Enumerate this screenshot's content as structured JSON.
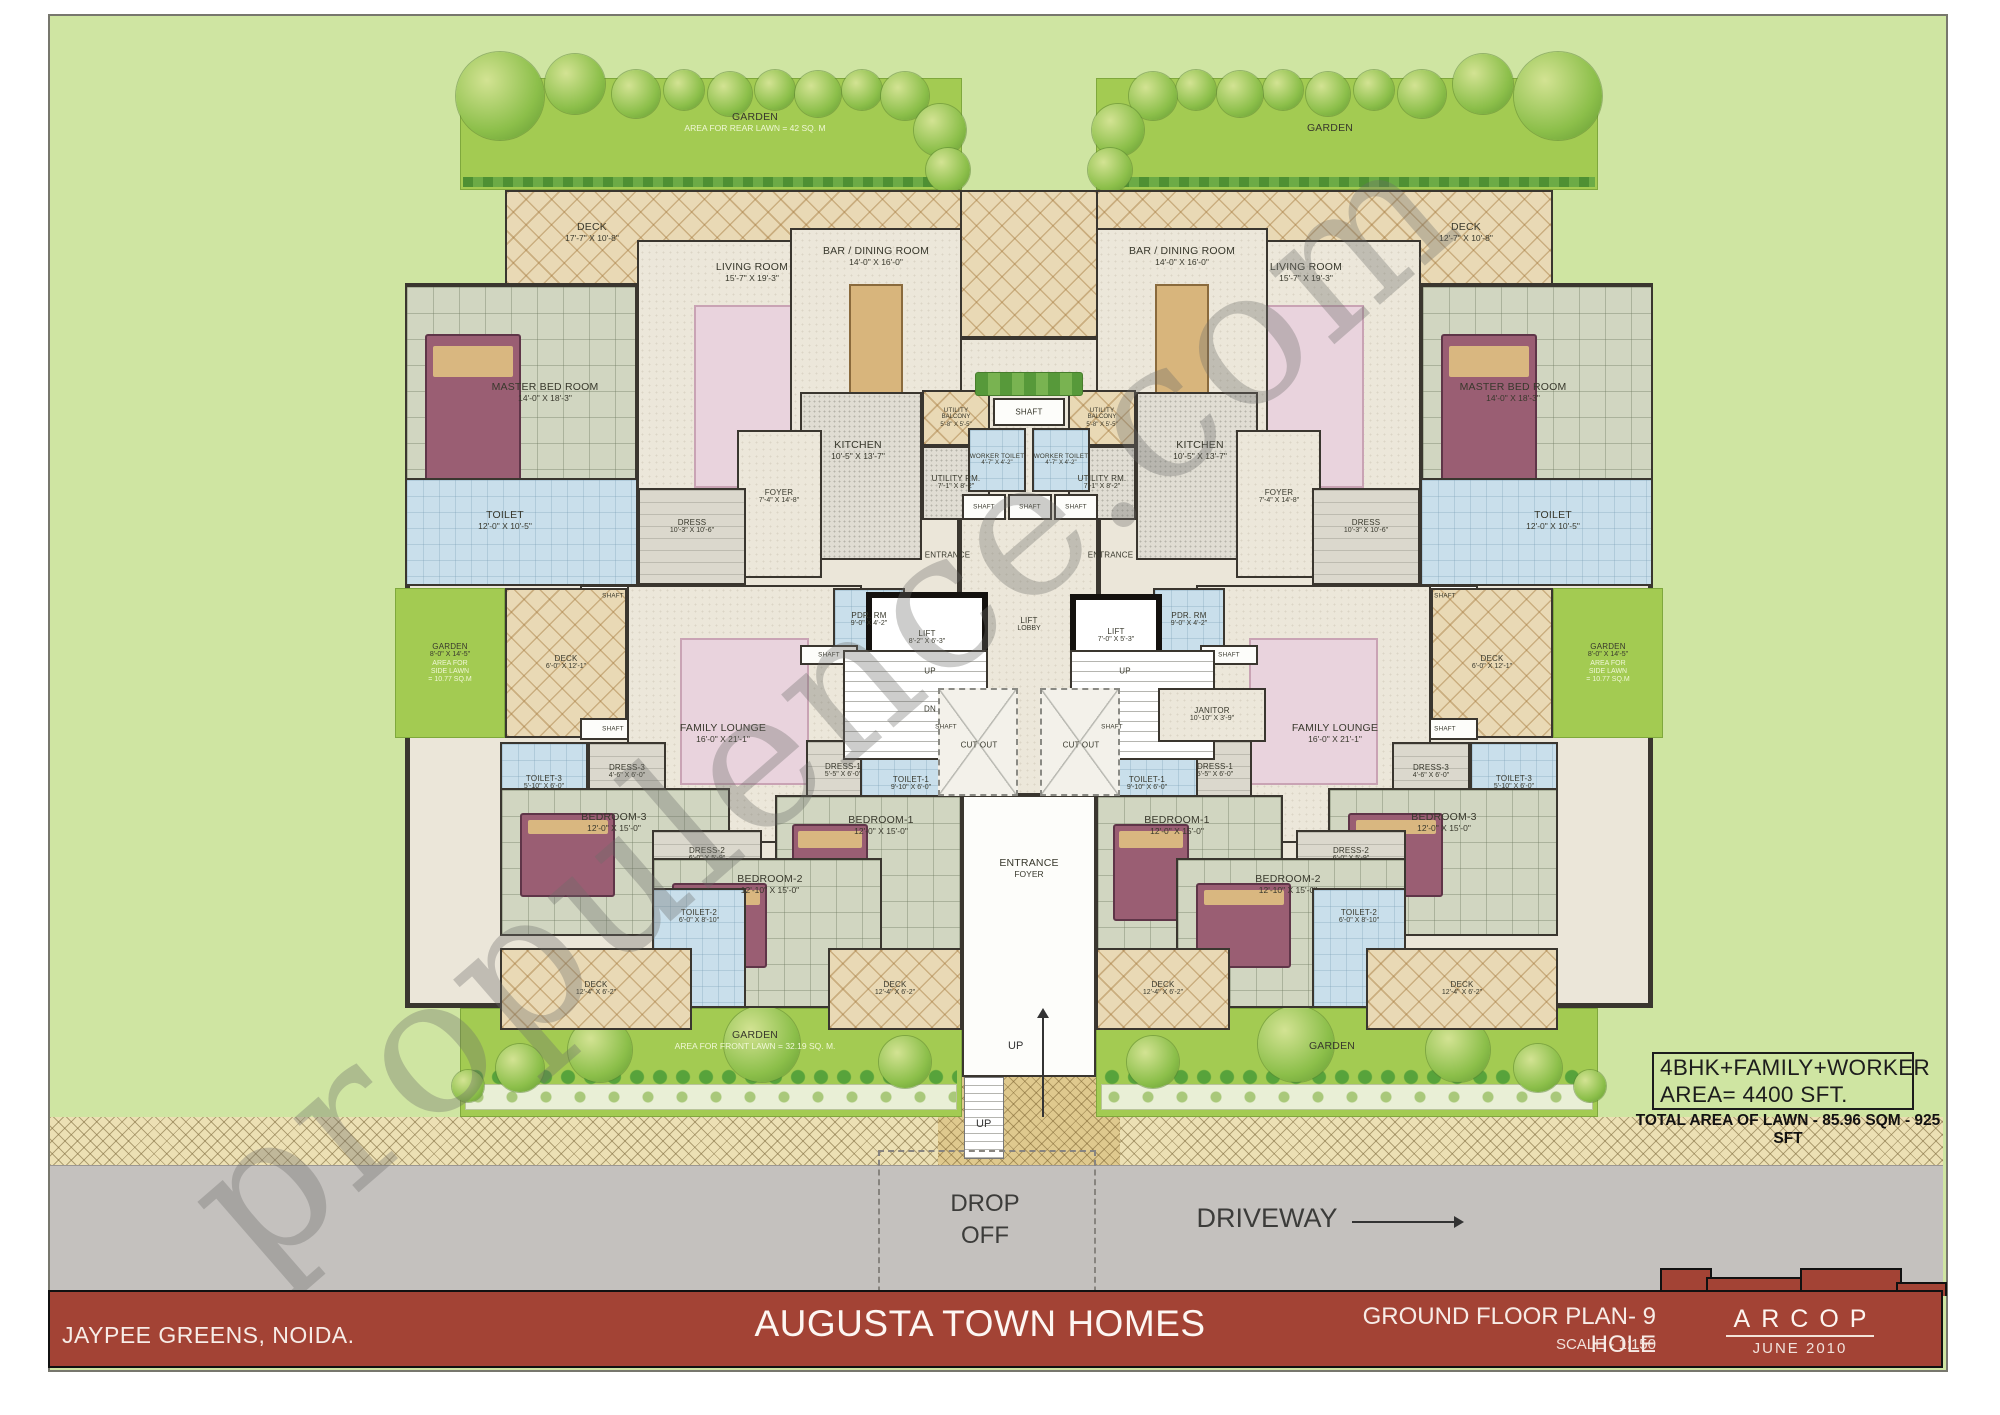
{
  "watermark": "propulence.com",
  "title_bar": {
    "left": "JAYPEE GREENS, NOIDA.",
    "title": "AUGUSTA TOWN HOMES",
    "plan": "GROUND FLOOR PLAN- 9 HOLE",
    "scale": "SCALE - 1:150",
    "firm": "ARCOP",
    "date": "JUNE  2010"
  },
  "annotations": {
    "line1": "4BHK+FAMILY+WORKER",
    "line2": "AREA= 4400 SFT.",
    "line3": "TOTAL AREA OF LAWN - 85.96 SQM - 925 SFT"
  },
  "site": {
    "drop_off_1": "DROP",
    "drop_off_2": "OFF",
    "driveway": "DRIVEWAY",
    "up": "UP"
  },
  "plan": {
    "background": [
      {
        "id": "center-deck",
        "cls": "hatch",
        "x": 880,
        "y": 190,
        "w": 298,
        "h": 148
      },
      {
        "id": "core-floor",
        "cls": "beige",
        "x": 903,
        "y": 338,
        "w": 252,
        "h": 457
      },
      {
        "id": "drop-path",
        "cls": "herring",
        "x": 938,
        "y": 1077,
        "w": 182,
        "h": 88
      },
      {
        "id": "drop-ramp",
        "cls": "ramp",
        "x": 964,
        "y": 1077,
        "w": 40,
        "h": 82
      }
    ],
    "gardens": [
      {
        "id": "garden-rear-left",
        "cls": "lawn",
        "x": 460,
        "y": 78,
        "w": 502,
        "h": 112,
        "lx": 755,
        "ly": 122,
        "lines": [
          "GARDEN",
          "AREA FOR REAR LAWN = 42 SQ. M"
        ],
        "light": 1,
        "strip": "hedge"
      },
      {
        "id": "garden-rear-right",
        "cls": "lawn",
        "x": 1096,
        "y": 78,
        "w": 502,
        "h": 112,
        "lx": 1330,
        "ly": 128,
        "lines": [
          "GARDEN"
        ],
        "strip": "hedge"
      },
      {
        "id": "garden-front-left",
        "cls": "lawn",
        "x": 460,
        "y": 1008,
        "w": 502,
        "h": 109,
        "lx": 755,
        "ly": 1040,
        "lines": [
          "GARDEN",
          "AREA FOR FRONT LAWN = 32.19 SQ. M."
        ],
        "light": 1,
        "strip": "shrub"
      },
      {
        "id": "garden-front-right",
        "cls": "lawn",
        "x": 1096,
        "y": 1008,
        "w": 502,
        "h": 109,
        "lx": 1332,
        "ly": 1046,
        "lines": [
          "GARDEN"
        ],
        "strip": "shrub"
      }
    ],
    "unit_rooms": [
      {
        "id": "deck-top",
        "cls": "hatch",
        "x": 505,
        "y": 190,
        "w": 457,
        "h": 95,
        "lx": 592,
        "ly": 232,
        "lines": [
          "DECK",
          "17'-7\" X 10'-8\""
        ],
        "rlines": [
          "DECK",
          "12'-7\" X 10'-8\""
        ]
      },
      {
        "id": "shell",
        "cls": "shell",
        "x": 405,
        "y": 283,
        "w": 557,
        "h": 725
      },
      {
        "id": "master-bed-room",
        "cls": "tile",
        "x": 405,
        "y": 285,
        "w": 232,
        "h": 300,
        "lx": 545,
        "ly": 392,
        "lines": [
          "MASTER BED ROOM",
          "14'-0\" X 18'-3\""
        ],
        "decor": "bed"
      },
      {
        "id": "living-room",
        "cls": "beige",
        "x": 637,
        "y": 240,
        "w": 252,
        "h": 320,
        "lx": 752,
        "ly": 272,
        "lines": [
          "LIVING ROOM",
          "15'-7\" X 19'-3\""
        ],
        "decor": "rug"
      },
      {
        "id": "bar-dining-room",
        "cls": "beige",
        "x": 790,
        "y": 228,
        "w": 172,
        "h": 230,
        "lx": 876,
        "ly": 256,
        "lines": [
          "BAR / DINING ROOM",
          "14'-0\" X 16'-0\""
        ],
        "decor": "table"
      },
      {
        "id": "kitchen",
        "cls": "kitchenf",
        "x": 800,
        "y": 392,
        "w": 122,
        "h": 168,
        "lx": 858,
        "ly": 450,
        "lines": [
          "KITCHEN",
          "10'-5\" X 13'-7\""
        ]
      },
      {
        "id": "foyer",
        "cls": "beige",
        "x": 737,
        "y": 430,
        "w": 85,
        "h": 148,
        "lx": 779,
        "ly": 497,
        "lines": [
          "FOYER",
          "7'-4\" X 14'-8\""
        ],
        "small": true
      },
      {
        "id": "toilet-master",
        "cls": "blue",
        "x": 405,
        "y": 478,
        "w": 233,
        "h": 108,
        "lx": 505,
        "ly": 520,
        "lines": [
          "TOILET",
          "12'-0\" X 10'-5\""
        ]
      },
      {
        "id": "dress-master",
        "cls": "grey",
        "x": 638,
        "y": 488,
        "w": 108,
        "h": 97,
        "lx": 692,
        "ly": 527,
        "lines": [
          "DRESS",
          "10'-3\" X 10'-6\""
        ],
        "small": true
      },
      {
        "id": "utility-balcony",
        "cls": "hatch",
        "x": 922,
        "y": 390,
        "w": 68,
        "h": 56,
        "lines": [
          "UTILITY",
          "BALCONY",
          "5'-8\" X 5'-5\""
        ],
        "small": true,
        "tiny": true
      },
      {
        "id": "utility-rm",
        "cls": "kitchenf",
        "x": 922,
        "y": 446,
        "w": 68,
        "h": 74,
        "lines": [
          "UTILITY RM.",
          "7'-1\" X 8'-2\""
        ],
        "small": true
      },
      {
        "id": "shaft-a",
        "cls": "white",
        "x": 580,
        "y": 585,
        "w": 66,
        "h": 22,
        "lines": [
          "SHAFT"
        ],
        "small": true,
        "tiny": true
      },
      {
        "id": "garden-side",
        "cls": "lawn",
        "x": 395,
        "y": 588,
        "w": 110,
        "h": 150,
        "lines": [
          "GARDEN",
          "8'-0\" X 14'-5\"",
          "AREA FOR",
          "SIDE LAWN",
          "= 10.77 SQ.M"
        ],
        "light": 2,
        "small": true
      },
      {
        "id": "deck-side",
        "cls": "hatch",
        "x": 505,
        "y": 588,
        "w": 122,
        "h": 150,
        "lines": [
          "DECK",
          "6'-0\" X 12'-1\""
        ],
        "small": true
      },
      {
        "id": "shaft-b",
        "cls": "white",
        "x": 580,
        "y": 718,
        "w": 66,
        "h": 22,
        "lines": [
          "SHAFT"
        ],
        "small": true,
        "tiny": true
      },
      {
        "id": "family-lounge",
        "cls": "beige",
        "x": 627,
        "y": 585,
        "w": 235,
        "h": 258,
        "lx": 723,
        "ly": 733,
        "lines": [
          "FAMILY LOUNGE",
          "16'-0\" X 21'-1\""
        ],
        "decor": "rug"
      },
      {
        "id": "pdr-rm",
        "cls": "blue",
        "x": 833,
        "y": 588,
        "w": 72,
        "h": 64,
        "lines": [
          "PDR. RM",
          "9'-0\" X 4'-2\""
        ],
        "small": true
      },
      {
        "id": "shaft-c",
        "cls": "white",
        "x": 800,
        "y": 645,
        "w": 58,
        "h": 20,
        "lines": [
          "SHAFT"
        ],
        "small": true,
        "tiny": true
      },
      {
        "id": "dress-3",
        "cls": "grey",
        "x": 588,
        "y": 742,
        "w": 78,
        "h": 60,
        "lines": [
          "DRESS-3",
          "4'-6\" X 6'-0\""
        ],
        "small": true
      },
      {
        "id": "toilet-3",
        "cls": "blue",
        "x": 500,
        "y": 742,
        "w": 88,
        "h": 82,
        "lines": [
          "TOILET-3",
          "5'-10\" X 6'-0\""
        ],
        "small": true
      },
      {
        "id": "dress-1",
        "cls": "grey",
        "x": 806,
        "y": 740,
        "w": 74,
        "h": 62,
        "lines": [
          "DRESS-1",
          "5'-5\" X 6'-0\""
        ],
        "small": true
      },
      {
        "id": "toilet-1",
        "cls": "blue",
        "x": 860,
        "y": 735,
        "w": 102,
        "h": 97,
        "lines": [
          "TOILET-1",
          "9'-10\" X 6'-0\""
        ],
        "small": true
      },
      {
        "id": "shaft-d",
        "cls": "white",
        "x": 925,
        "y": 718,
        "w": 42,
        "h": 18,
        "lines": [
          "SHAFT"
        ],
        "small": true,
        "tiny": true
      },
      {
        "id": "bedroom-3",
        "cls": "tile",
        "x": 500,
        "y": 788,
        "w": 230,
        "h": 148,
        "lx": 614,
        "ly": 822,
        "lines": [
          "BEDROOM-3",
          "12'-0\" X 15'-0\""
        ],
        "decor": "bed"
      },
      {
        "id": "bedroom-1",
        "cls": "tile",
        "x": 775,
        "y": 795,
        "w": 187,
        "h": 172,
        "lx": 881,
        "ly": 825,
        "lines": [
          "BEDROOM-1",
          "12'-0\" X 15'-0\""
        ],
        "decor": "bed"
      },
      {
        "id": "dress-2",
        "cls": "grey",
        "x": 652,
        "y": 830,
        "w": 110,
        "h": 62,
        "lx": 707,
        "ly": 855,
        "lines": [
          "DRESS-2",
          "6'-0\" X 5'-9\""
        ],
        "small": true
      },
      {
        "id": "bedroom-2",
        "cls": "tile",
        "x": 652,
        "y": 858,
        "w": 230,
        "h": 150,
        "lx": 770,
        "ly": 884,
        "lines": [
          "BEDROOM-2",
          "12'-10\" X 15'-0\""
        ],
        "decor": "bed"
      },
      {
        "id": "toilet-2",
        "cls": "blue",
        "x": 652,
        "y": 888,
        "w": 94,
        "h": 120,
        "lx": 699,
        "ly": 917,
        "lines": [
          "TOILET-2",
          "6'-0\" X 8'-10\""
        ],
        "small": true
      },
      {
        "id": "deck-bottom-outer",
        "cls": "hatch",
        "x": 500,
        "y": 948,
        "w": 192,
        "h": 82,
        "lines": [
          "DECK",
          "12'-4\" X 6'-2\""
        ],
        "small": true
      },
      {
        "id": "deck-bottom-inner",
        "cls": "hatch",
        "x": 828,
        "y": 948,
        "w": 134,
        "h": 82,
        "lines": [
          "DECK",
          "12'-4\" X 6'-2\""
        ],
        "small": true
      }
    ],
    "core_rooms": [
      {
        "id": "entrance-foyer",
        "cls": "white",
        "x": 962,
        "y": 795,
        "w": 134,
        "h": 282,
        "lx": 1029,
        "ly": 868,
        "lines": [
          "ENTRANCE",
          "FOYER"
        ]
      },
      {
        "id": "hedge-row",
        "cls": "hedge",
        "x": 975,
        "y": 372,
        "w": 108,
        "h": 24
      },
      {
        "id": "shaft-top",
        "cls": "white",
        "x": 993,
        "y": 398,
        "w": 72,
        "h": 28,
        "lines": [
          "SHAFT"
        ],
        "small": true
      },
      {
        "id": "worker-toilet-left",
        "cls": "blue",
        "x": 968,
        "y": 428,
        "w": 58,
        "h": 64,
        "lines": [
          "WORKER TOILET",
          "4'-7\" X 4'-2\""
        ],
        "small": true,
        "tiny": true
      },
      {
        "id": "worker-toilet-right",
        "cls": "blue",
        "x": 1032,
        "y": 428,
        "w": 58,
        "h": 64,
        "lines": [
          "WORKER TOILET",
          "4'-7\" X 4'-2\""
        ],
        "small": true,
        "tiny": true
      },
      {
        "id": "shaft-1",
        "cls": "white",
        "x": 962,
        "y": 494,
        "w": 44,
        "h": 26,
        "lines": [
          "SHAFT"
        ],
        "small": true,
        "tiny": true
      },
      {
        "id": "shaft-2",
        "cls": "white",
        "x": 1008,
        "y": 494,
        "w": 44,
        "h": 26,
        "lines": [
          "SHAFT"
        ],
        "small": true,
        "tiny": true
      },
      {
        "id": "shaft-3",
        "cls": "white",
        "x": 1054,
        "y": 494,
        "w": 44,
        "h": 26,
        "lines": [
          "SHAFT"
        ],
        "small": true,
        "tiny": true
      },
      {
        "id": "entrance-left",
        "cls": "labelonly",
        "x": 900,
        "y": 542,
        "w": 95,
        "h": 26,
        "lines": [
          "ENTRANCE"
        ],
        "small": true
      },
      {
        "id": "entrance-right",
        "cls": "labelonly",
        "x": 1063,
        "y": 542,
        "w": 95,
        "h": 26,
        "lines": [
          "ENTRANCE"
        ],
        "small": true
      },
      {
        "id": "lift-left",
        "cls": "lift",
        "x": 866,
        "y": 592,
        "w": 122,
        "h": 92,
        "lines": [
          "LIFT",
          "8'-2\" X 6'-3\""
        ],
        "small": true
      },
      {
        "id": "lift-right",
        "cls": "lift",
        "x": 1070,
        "y": 594,
        "w": 92,
        "h": 84,
        "lines": [
          "LIFT",
          "7'-0\" X 5'-3\""
        ],
        "small": true
      },
      {
        "id": "lift-lobby",
        "cls": "labelonly",
        "x": 984,
        "y": 605,
        "w": 90,
        "h": 40,
        "lines": [
          "LIFT",
          "LOBBY"
        ],
        "small": true
      },
      {
        "id": "stairs-left",
        "cls": "stairs",
        "x": 843,
        "y": 650,
        "w": 145,
        "h": 110
      },
      {
        "id": "stairs-right",
        "cls": "stairs",
        "x": 1070,
        "y": 650,
        "w": 145,
        "h": 110
      },
      {
        "id": "up-left",
        "cls": "labelonly",
        "x": 905,
        "y": 662,
        "w": 50,
        "h": 18,
        "lines": [
          "UP"
        ],
        "small": true
      },
      {
        "id": "dn-left",
        "cls": "labelonly",
        "x": 905,
        "y": 700,
        "w": 50,
        "h": 18,
        "lines": [
          "DN"
        ],
        "small": true
      },
      {
        "id": "up-right",
        "cls": "labelonly",
        "x": 1100,
        "y": 662,
        "w": 50,
        "h": 18,
        "lines": [
          "UP"
        ],
        "small": true
      },
      {
        "id": "janitor",
        "cls": "beige",
        "x": 1158,
        "y": 688,
        "w": 108,
        "h": 54,
        "lines": [
          "JANITOR",
          "10'-10\" X 3'-9\""
        ],
        "small": true
      },
      {
        "id": "cut-out-left",
        "cls": "cutout",
        "x": 938,
        "y": 688,
        "w": 80,
        "h": 108,
        "lx": 979,
        "ly": 745,
        "lines": [
          "CUT OUT"
        ],
        "small": true
      },
      {
        "id": "cut-out-right",
        "cls": "cutout",
        "x": 1040,
        "y": 688,
        "w": 80,
        "h": 108,
        "lx": 1081,
        "ly": 745,
        "lines": [
          "CUT OUT"
        ],
        "small": true
      }
    ]
  },
  "decorations": {
    "icons": [
      "tree-icon",
      "shrub-row-icon",
      "hedge-row-icon",
      "bed-icon",
      "rug-icon",
      "table-icon",
      "up-arrow-icon",
      "driveway-arrow-icon"
    ],
    "trees": [
      [
        500,
        96,
        44
      ],
      [
        575,
        84,
        30
      ],
      [
        636,
        94,
        24
      ],
      [
        684,
        90,
        20
      ],
      [
        730,
        94,
        22
      ],
      [
        775,
        90,
        20
      ],
      [
        818,
        94,
        23
      ],
      [
        862,
        90,
        20
      ],
      [
        905,
        96,
        24
      ],
      [
        940,
        130,
        26
      ],
      [
        948,
        170,
        22
      ],
      [
        520,
        1068,
        24
      ],
      [
        600,
        1050,
        32
      ],
      [
        762,
        1044,
        38
      ],
      [
        905,
        1062,
        26
      ],
      [
        468,
        1086,
        16
      ]
    ]
  }
}
